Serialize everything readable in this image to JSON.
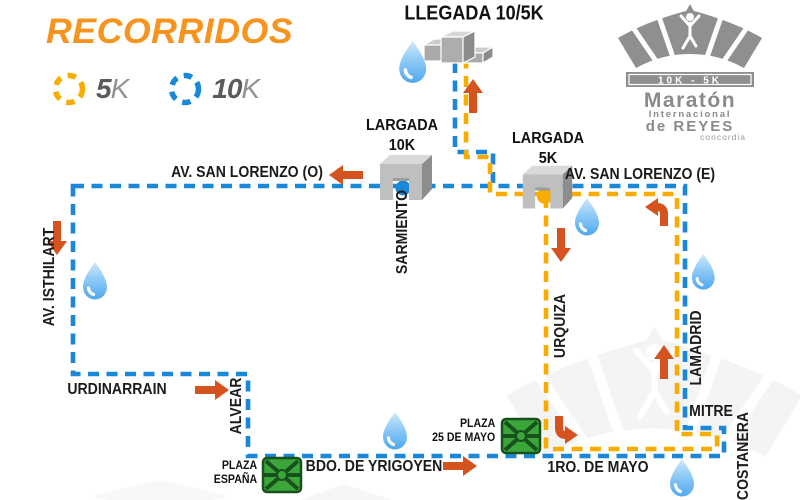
{
  "palette": {
    "accent_orange": "#F7941E",
    "arrow_orange": "#D4531F",
    "route_blue_10k": "#1B87D9",
    "route_yellow_5k": "#F8AC00",
    "logo_gray": "#8A8A8A",
    "plaza_green": "#3DA63B",
    "water_drop_blue": "#57AFF0"
  },
  "header": {
    "title": "RECORRIDOS"
  },
  "legend": {
    "k5": {
      "num": "5",
      "unit": "K"
    },
    "k10": {
      "num": "10",
      "unit": "K"
    }
  },
  "logo": {
    "distances": "10K - 5K",
    "line1": "Maratón",
    "line2": "Internacional",
    "line3": "de REYES",
    "city": "concordia"
  },
  "markers": {
    "finish": {
      "label": "LLEGADA 10/5K"
    },
    "start_10k": {
      "line1": "LARGADA",
      "line2": "10K"
    },
    "start_5k": {
      "line1": "LARGADA",
      "line2": "5K"
    }
  },
  "streets": {
    "san_lorenzo_o": "AV. SAN LORENZO (O)",
    "san_lorenzo_e": "AV. SAN LORENZO (E)",
    "sarmiento": "SARMIENTO",
    "isthilart": "AV. ISTHILART",
    "urdinarrain": "URDINARRAIN",
    "alvear": "ALVEAR",
    "yrigoyen": "BDO. DE YRIGOYEN",
    "primero_de_mayo": "1RO. DE MAYO",
    "urquiza": "URQUIZA",
    "lamadrid": "LAMADRID",
    "mitre": "MITRE",
    "costanera": "COSTANERA"
  },
  "plazas": {
    "espana": {
      "line1": "PLAZA",
      "line2": "ESPAÑA"
    },
    "mayo_25": {
      "line1": "PLAZA",
      "line2": "25 DE MAYO"
    }
  }
}
